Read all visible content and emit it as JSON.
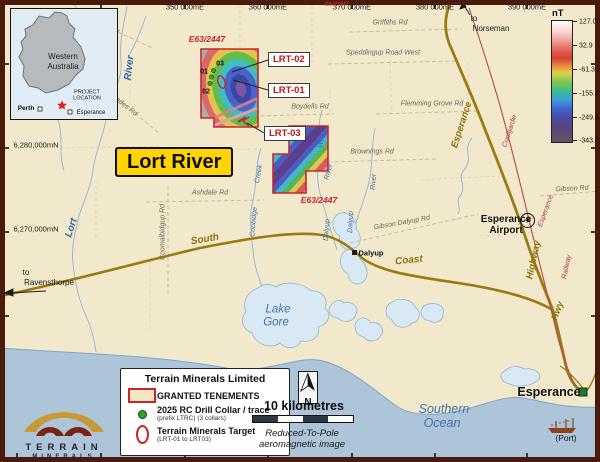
{
  "colors": {
    "land": "#f2e9cd",
    "ocean": "#aec4d9",
    "highway": "#9a7b10",
    "railway": "#b5474f",
    "tenement_red": "#c92727",
    "title_bg": "#FFD400",
    "lake": "#d9e9f4"
  },
  "axes": {
    "top": [
      "350 000mE",
      "360 000mE",
      "370 000mE",
      "380 000mE",
      "390 000mE"
    ],
    "left": [
      "6,280,000mN",
      "6,270,000mN"
    ]
  },
  "colorbar": {
    "unit": "nT",
    "ticks": [
      "127.0",
      "32.9",
      "-61.3",
      "-155.4",
      "-249.6",
      "-343.7"
    ]
  },
  "inset": {
    "region1": "Western",
    "region2": "Australia",
    "project1": "PROJECT",
    "project2": "LOCATION",
    "perth": "Perth",
    "esperance": "Esperance"
  },
  "title": "Lort River",
  "tenement_id": "E63/2447",
  "targets": {
    "t1": "LRT-02",
    "t2": "LRT-01",
    "t3": "LRT-03"
  },
  "collars": {
    "c1": "01",
    "c2": "03",
    "c3": "02"
  },
  "roads": {
    "griffiths_nw": "Griffiths Rd",
    "griffiths_ne": "Griffiths Rd",
    "cascades": "Cascades Rd",
    "speddingup": "Speddingup Road West",
    "flemming": "Flemming Grove Rd",
    "boydells": "Boydells Rd",
    "brownings": "Brownings Rd",
    "ashdale": "Ashdale Rd",
    "coomalbidgup": "Coomalbidgup Rd",
    "gibson": "Gibson Rd",
    "gibson_dalyup": "Gibson Dalyup Rd"
  },
  "water": {
    "river_upper": "River",
    "lort": "Lort",
    "west1": "West",
    "west2": "River",
    "dalyup_r1": "Dalyup",
    "dalyup_r2": "River",
    "dalyup_r3": "Dalyup",
    "coobidge1": "Coobidge",
    "coobidge2": "Creek",
    "lake1": "Lake",
    "lake2": "Gore",
    "ocean1": "Southern",
    "ocean2": "Ocean"
  },
  "highways": {
    "south": "South",
    "coast": "Coast",
    "hwy": "Hwy",
    "esperance": "Esperance",
    "highway": "Highway",
    "to1": "to",
    "ravensthorpe": "Ravensthorpe",
    "to2": "to",
    "norseman": "Norseman"
  },
  "railway": {
    "coolgardie": "Coolgardie",
    "esperance": "Esperance",
    "railway": "Railway"
  },
  "places": {
    "dalyup": "Dalyup",
    "airport1": "Esperance",
    "airport2": "Airport",
    "esperance": "Esperance",
    "port": "(Port)"
  },
  "legend": {
    "title": "Terrain Minerals Limited",
    "granted": "GRANTED TENEMENTS",
    "drill": "2025 RC Drill Collar / trace",
    "drill_sub": "(prefix LTRC) (3 collars)",
    "target": "Terrain Minerals Target",
    "target_sub": "(LRT-01 to LRT03)"
  },
  "scalebar": {
    "label": "10 kilometres",
    "cap1": "Reduced-To-Pole",
    "cap2": "aeromagnetic image"
  },
  "north_label": "N",
  "logo": {
    "l1": "TERRAIN",
    "l2": "MINERALS"
  }
}
